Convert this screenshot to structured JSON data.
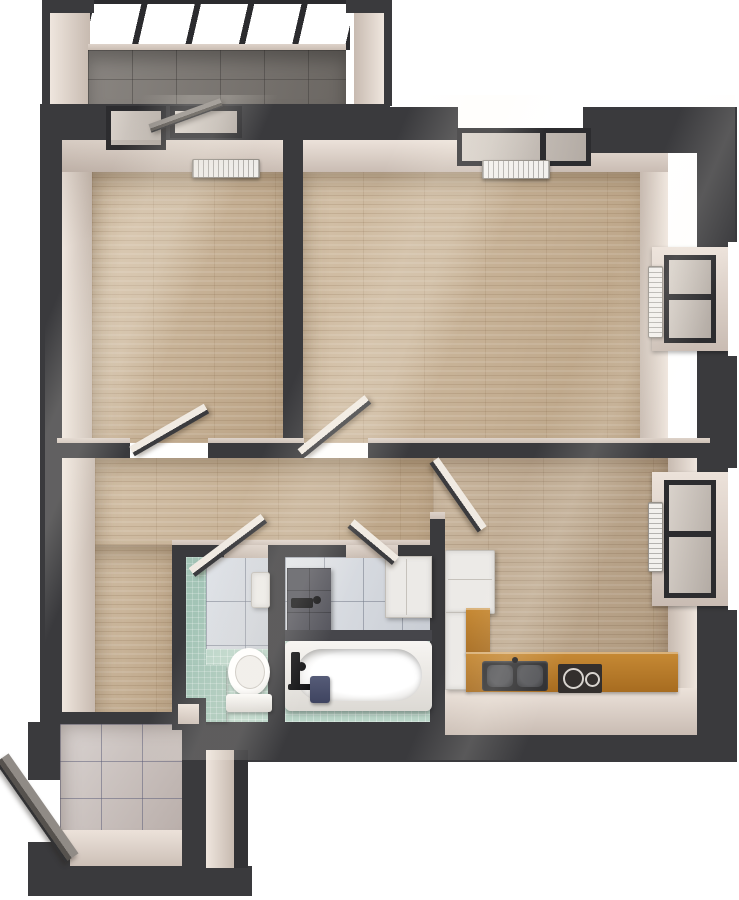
{
  "scene": {
    "kind": "3d-rendered-floor-plan",
    "view": "top-down dollhouse render of a two-room apartment",
    "background": "#ffffff",
    "visible_text": "none"
  },
  "palette": {
    "walls": "#3a3a3d",
    "wall_faces": "#e0d5cc",
    "wood_floor": "#c9b294",
    "kitchen_wood_floor": "#c0aa8f",
    "balcony_tile": "#7c7772",
    "entry_tile": "#c9c0bd",
    "bathroom_floor_tile": "#b9d4c7",
    "bathroom_wall_tile": "#d8dce2",
    "kitchen_counter": "#b87b2c",
    "window_frames": "#2c2c2f",
    "fixtures_white": "#eceae7",
    "shower_panel": "#56565e",
    "entry_door": "#6e6a65",
    "accent_stool": "#4a4f68"
  },
  "rooms": [
    {
      "name": "loggia-balcony",
      "position": "top-left",
      "floor": "gray ceramic tile",
      "features": [
        "full-width glazing with dark diagonal mullions",
        "open glazed door leaf"
      ]
    },
    {
      "name": "bedroom",
      "position": "upper-left",
      "floor": "light oak planks",
      "features": [
        "balcony door",
        "balcony window",
        "radiator under window",
        "open interior door"
      ]
    },
    {
      "name": "living-room",
      "position": "upper-right",
      "floor": "light oak planks",
      "features": [
        "street-facing top window with radiator",
        "side bay window with radiator",
        "open interior door"
      ]
    },
    {
      "name": "hallway",
      "position": "center and lower-left",
      "floor": "light oak planks",
      "features": [
        "open doors to bedroom, living room, kitchen, bathroom and WC",
        "threshold to entry vestibule"
      ]
    },
    {
      "name": "wc",
      "position": "bottom-center-left",
      "floor": "mint mosaic tile",
      "fixtures": [
        "toilet",
        "tiled bench ledge",
        "small wall boiler"
      ]
    },
    {
      "name": "bathroom",
      "position": "bottom-center",
      "floor": "mint mosaic tile",
      "fixtures": [
        "bathtub with black faucet",
        "dark tiled shower wall panel",
        "washing machine",
        "navy step stool"
      ]
    },
    {
      "name": "kitchen",
      "position": "bottom-right",
      "floor": "light oak planks",
      "fixtures": [
        "refrigerator",
        "L-shaped wooden counter",
        "double-bowl dark sink",
        "two-burner cooktop",
        "side bay window with radiator"
      ]
    },
    {
      "name": "entry-vestibule",
      "position": "bottom-left protrusion",
      "floor": "large gray floor tiles",
      "fixtures": [
        "open dark entrance door",
        "small wall niche"
      ]
    }
  ],
  "windows": [
    {
      "name": "balcony-glazing",
      "wall": "top",
      "style": "continuous glass with dark mullions"
    },
    {
      "name": "bedroom-balcony-door-and-window",
      "wall": "top"
    },
    {
      "name": "living-room-top-window",
      "wall": "top",
      "radiator": true
    },
    {
      "name": "living-room-side-window",
      "wall": "right",
      "radiator": true
    },
    {
      "name": "kitchen-side-window",
      "wall": "right",
      "radiator": true
    }
  ],
  "doors": [
    {
      "name": "bedroom-door",
      "state": "open"
    },
    {
      "name": "living-room-door",
      "state": "open"
    },
    {
      "name": "kitchen-door",
      "state": "open"
    },
    {
      "name": "wc-door",
      "state": "open"
    },
    {
      "name": "bathroom-door",
      "state": "open"
    },
    {
      "name": "entrance-door",
      "state": "open",
      "color": "dark gray"
    }
  ]
}
